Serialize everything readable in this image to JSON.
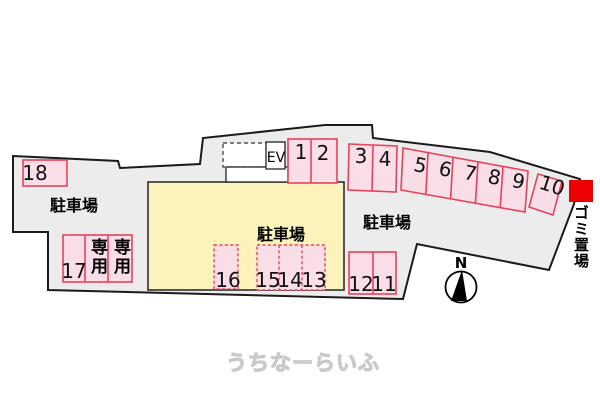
{
  "map_title": "parking-lot-site-plan",
  "colors": {
    "lot_fill": "#ececec",
    "outline": "#1b1b1b",
    "space_fill": "#fadee7",
    "space_border": "#e8415c",
    "building_fill": "#fbf3bb",
    "garbage_marker_fill": "#ee0000",
    "watermark_fill": "#fdfdfd",
    "watermark_stroke": "#c9c9c9"
  },
  "labels": {
    "parking_left": "駐車場",
    "parking_center": "駐車場",
    "parking_right": "駐車場",
    "garbage_area": "ゴミ置場",
    "elevator": "EV",
    "north": "N",
    "reserved_a": "専用",
    "reserved_b": "専用",
    "watermark": "うちなーらいふ"
  },
  "spaces": {
    "s1": "1",
    "s2": "2",
    "s3": "3",
    "s4": "4",
    "s5": "5",
    "s6": "6",
    "s7": "7",
    "s8": "8",
    "s9": "9",
    "s10": "10",
    "s11": "11",
    "s12": "12",
    "s13": "13",
    "s14": "14",
    "s15": "15",
    "s16": "16",
    "s17": "17",
    "s18": "18"
  }
}
